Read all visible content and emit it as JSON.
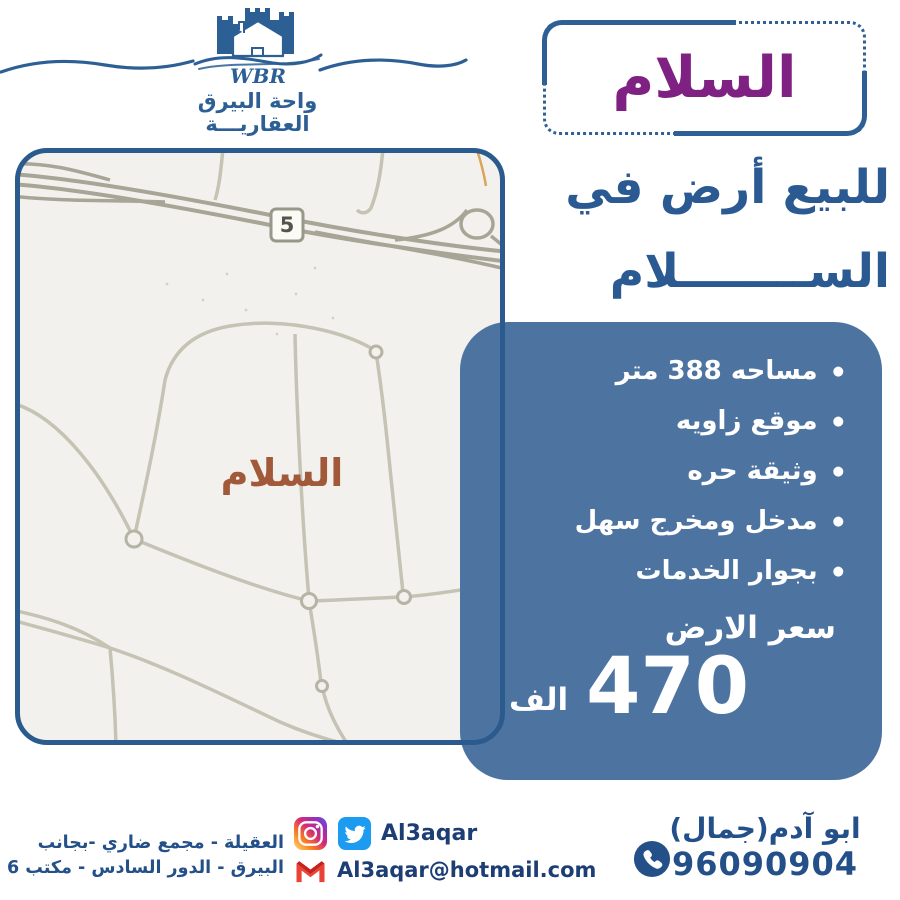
{
  "brand": {
    "initials": "WBR",
    "name_line1": "واحة البيرق",
    "name_line2": "العقاريـــة"
  },
  "title_badge": {
    "text": "السلام"
  },
  "listing": {
    "headline_line1": "للبيع أرض في",
    "headline_line2": "الســــــــلام"
  },
  "map": {
    "district_label": "السلام",
    "route_shield": "5"
  },
  "features": [
    "مساحه 388 متر",
    "موقع زاويه",
    "وثيقة حره",
    "مدخل ومخرج سهل",
    "بجوار الخدمات"
  ],
  "price": {
    "label": "سعر الارض",
    "amount": "470",
    "unit": "الف"
  },
  "contact": {
    "agent_name": "ابو آدم(جمال)",
    "phone": "96090904",
    "social_handle": "Al3aqar",
    "email": "Al3aqar@hotmail.com",
    "address_line1": "العقيلة - مجمع ضاري -بجانب",
    "address_line2": "البيرق - الدور السادس - مكتب 6"
  },
  "colors": {
    "accent_blue": "#2c5f94",
    "panel_blue": "#4d74a1",
    "title_purple": "#7e2183",
    "map_label_brown": "#a2593a"
  }
}
